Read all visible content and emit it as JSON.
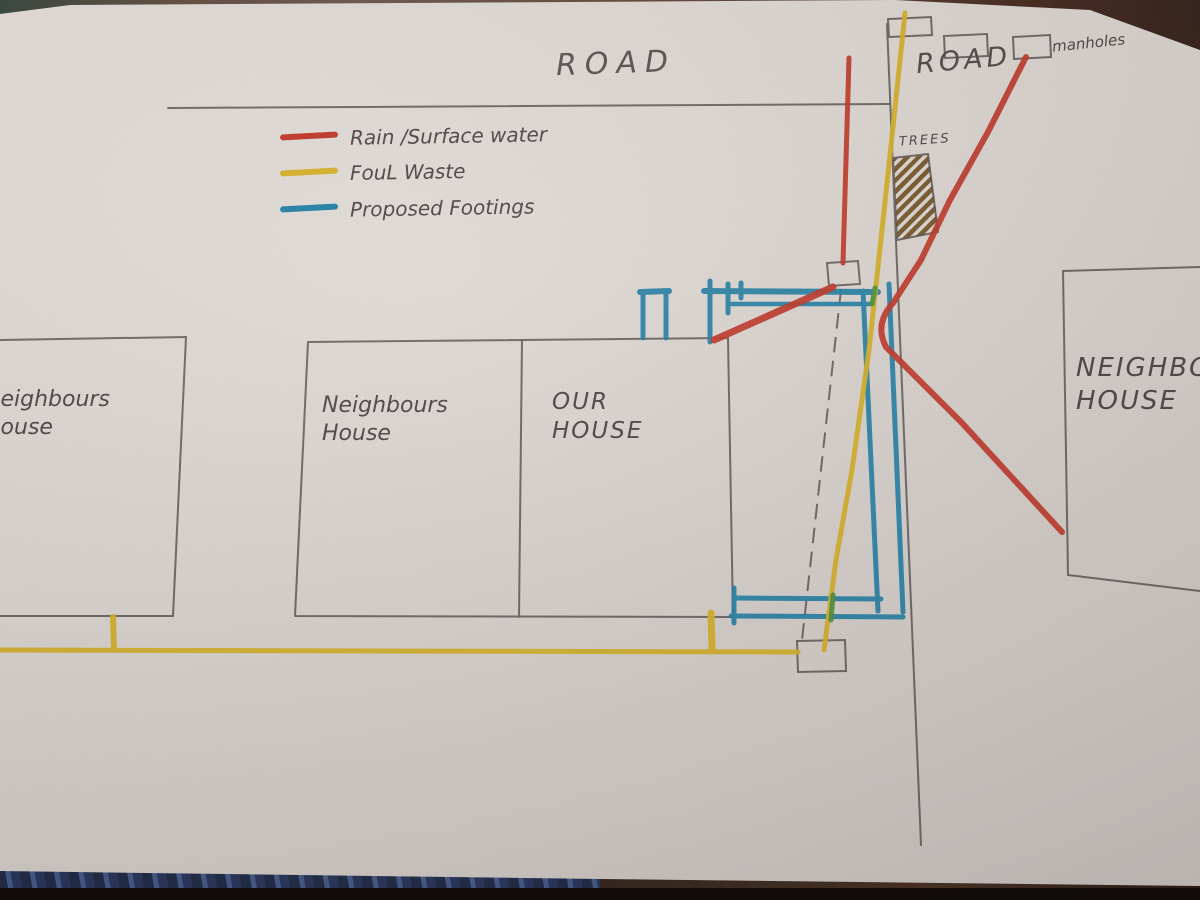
{
  "colors": {
    "rain_surface_water_red": "#c0392b",
    "foul_waste_yellow": "#d4b02a",
    "proposed_footings_blue": "#2380a5",
    "pencil_gray": "#5b5553",
    "tree_hatch_brown": "#6e4d1e",
    "paper": "#d9d3cf"
  },
  "legend": {
    "items": [
      {
        "name": "rain-surface-water",
        "label": "Rain /Surface water",
        "color": "#c0392b"
      },
      {
        "name": "foul-waste",
        "label": "FouL Waste",
        "color": "#d4b02a"
      },
      {
        "name": "proposed-footings",
        "label": "Proposed Footings",
        "color": "#2380a5"
      }
    ]
  },
  "labels": {
    "road_main": "ROAD",
    "road_side": "ROAD",
    "manholes": "manholes",
    "trees": "TREES"
  },
  "houses": {
    "left": {
      "line1": "Neighbours",
      "line2": "House"
    },
    "middle": {
      "line1": "Neighbours",
      "line2": "House"
    },
    "our": {
      "line1": "OUR",
      "line2": "HOUSE"
    },
    "right": {
      "line1": "NEIGHBOUR",
      "line2": "HOUSE"
    }
  }
}
